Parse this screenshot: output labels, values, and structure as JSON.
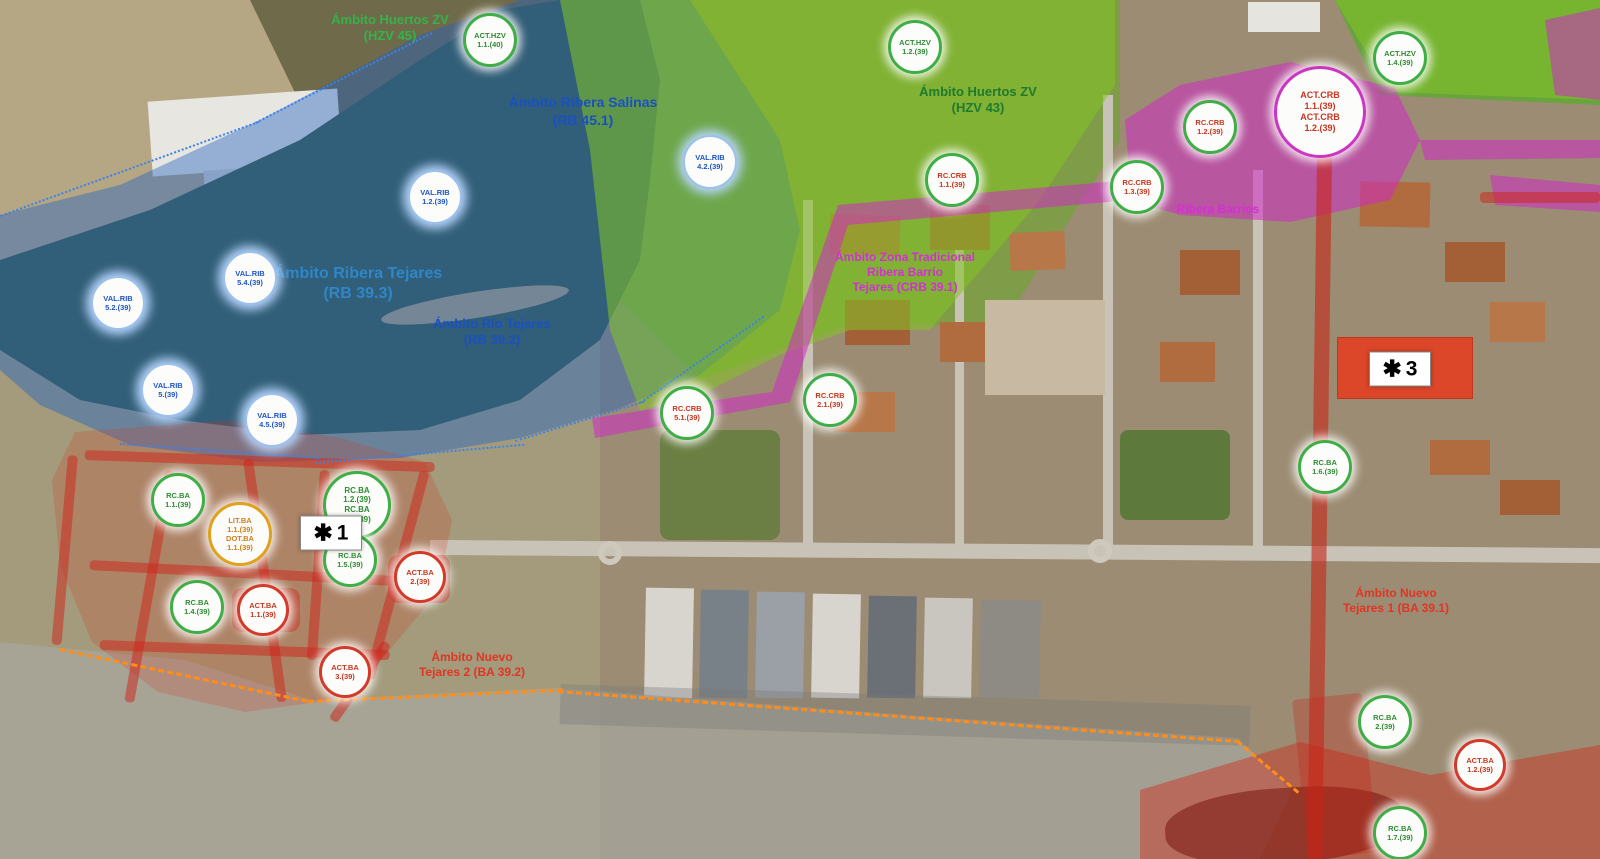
{
  "map": {
    "description": "Urban planning zoning overlay on aerial photo",
    "zone_colors": {
      "base": "#a39b7c",
      "tan_field": "#b5a684",
      "scrub": "#6f6a4a",
      "river": "#3e5c42",
      "sandbar": "#b3a176",
      "green_field_base": "#7f9c48",
      "grass_right": "#69a33e",
      "urban_base": "#9c8c73",
      "road_grey": "#c9c3b7",
      "blue_overlay": "rgba(32,98,196,0.42)",
      "green_overlay": "rgba(132,196,37,0.55)",
      "magenta_overlay": "rgba(207,42,196,0.55)",
      "red_overlay_blob": "rgba(214,48,34,0.22)",
      "red_road": "rgba(200,36,24,0.6)",
      "red_zone_br": "rgba(205,45,28,0.45)",
      "maroon_blob": "rgba(120,22,12,0.55)",
      "grey_overlay": "rgba(168,168,164,0.66)",
      "star3_zone": "rgba(232,58,28,0.85)"
    },
    "label_colors": {
      "green": "#35b24a",
      "darkgreen": "#1f7a2e",
      "blue": "#1b50c0",
      "lightblue": "#2f86c8",
      "magenta": "#d32fd3",
      "red": "#e03524"
    },
    "labels": [
      {
        "x": 390,
        "y": 12,
        "size": 13,
        "color": "green",
        "lines": [
          "Ámbito Huertos ZV",
          "(HZV 45)"
        ]
      },
      {
        "x": 583,
        "y": 94,
        "size": 14,
        "color": "blue",
        "lines": [
          "Ámbito Ribera Salinas",
          "(RB 45.1)"
        ]
      },
      {
        "x": 358,
        "y": 264,
        "size": 16,
        "color": "lightblue",
        "lines": [
          "Ámbito Ribera Tejares",
          "(RB 39.3)"
        ]
      },
      {
        "x": 492,
        "y": 316,
        "size": 13,
        "color": "blue",
        "lines": [
          "Ámbito Río Tejares",
          "(RB 39.2)"
        ]
      },
      {
        "x": 978,
        "y": 84,
        "size": 13,
        "color": "darkgreen",
        "lines": [
          "Ámbito Huertos ZV",
          "(HZV 43)"
        ]
      },
      {
        "x": 1218,
        "y": 202,
        "size": 12,
        "color": "magenta",
        "lines": [
          "Ribera Barrios"
        ]
      },
      {
        "x": 905,
        "y": 250,
        "size": 12,
        "color": "magenta",
        "lines": [
          "Ámbito Zona Tradicional",
          "Ribera Barrio",
          "Tejares (CRB 39.1)"
        ]
      },
      {
        "x": 472,
        "y": 650,
        "size": 12,
        "color": "red",
        "lines": [
          "Ámbito Nuevo",
          "Tejares 2 (BA 39.2)"
        ]
      },
      {
        "x": 1396,
        "y": 586,
        "size": 12,
        "color": "red",
        "lines": [
          "Ámbito Nuevo",
          "Tejares 1 (BA 39.1)"
        ]
      }
    ],
    "badges": [
      {
        "x": 490,
        "y": 40,
        "type": "act-hzv",
        "lines": [
          "ACT.HZV",
          "1.1.(40)"
        ]
      },
      {
        "x": 915,
        "y": 47,
        "type": "act-hzv",
        "lines": [
          "ACT.HZV",
          "1.2.(39)"
        ]
      },
      {
        "x": 1400,
        "y": 58,
        "type": "act-hzv",
        "lines": [
          "ACT.HZV",
          "1.4.(39)"
        ]
      },
      {
        "x": 710,
        "y": 162,
        "type": "val-rib",
        "lines": [
          "VAL.RIB",
          "4.2.(39)"
        ]
      },
      {
        "x": 435,
        "y": 197,
        "type": "val-rib",
        "lines": [
          "VAL.RIB",
          "1.2.(39)"
        ]
      },
      {
        "x": 250,
        "y": 278,
        "type": "val-rib",
        "lines": [
          "VAL.RIB",
          "5.4.(39)"
        ]
      },
      {
        "x": 118,
        "y": 303,
        "type": "val-rib",
        "lines": [
          "VAL.RIB",
          "5.2.(39)"
        ]
      },
      {
        "x": 168,
        "y": 390,
        "type": "val-rib",
        "lines": [
          "VAL.RIB",
          "5.(39)"
        ]
      },
      {
        "x": 272,
        "y": 420,
        "type": "val-rib",
        "lines": [
          "VAL.RIB",
          "4.5.(39)"
        ]
      },
      {
        "x": 1210,
        "y": 127,
        "type": "rc-crb",
        "lines": [
          "RC.CRB",
          "1.2.(39)"
        ]
      },
      {
        "x": 1320,
        "y": 112,
        "type": "act-crb",
        "lines": [
          "ACT.CRB",
          "1.1.(39)",
          "ACT.CRB",
          "1.2.(39)"
        ]
      },
      {
        "x": 952,
        "y": 180,
        "type": "rc-crb",
        "lines": [
          "RC.CRB",
          "1.1.(39)"
        ]
      },
      {
        "x": 1137,
        "y": 187,
        "type": "rc-crb",
        "lines": [
          "RC.CRB",
          "1.3.(39)"
        ]
      },
      {
        "x": 687,
        "y": 413,
        "type": "rc-crb",
        "lines": [
          "RC.CRB",
          "5.1.(39)"
        ]
      },
      {
        "x": 830,
        "y": 400,
        "type": "rc-crb",
        "lines": [
          "RC.CRB",
          "2.1.(39)"
        ]
      },
      {
        "x": 178,
        "y": 500,
        "type": "rc-ba",
        "lines": [
          "RC.BA",
          "1.1.(39)"
        ]
      },
      {
        "x": 357,
        "y": 505,
        "type": "rc-ba",
        "lines": [
          "RC.BA",
          "1.2.(39)",
          "RC.BA",
          "1.3.(39)"
        ]
      },
      {
        "x": 240,
        "y": 534,
        "type": "mixed-gold",
        "lines": [
          "LIT.BA",
          "1.1.(39)",
          "DOT.BA",
          "1.1.(39)"
        ]
      },
      {
        "x": 350,
        "y": 560,
        "type": "rc-ba",
        "lines": [
          "RC.BA",
          "1.5.(39)"
        ]
      },
      {
        "x": 420,
        "y": 577,
        "type": "act-ba",
        "lines": [
          "ACT.BA",
          "2.(39)"
        ]
      },
      {
        "x": 197,
        "y": 607,
        "type": "rc-ba",
        "lines": [
          "RC.BA",
          "1.4.(39)"
        ]
      },
      {
        "x": 263,
        "y": 610,
        "type": "act-ba",
        "lines": [
          "ACT.BA",
          "1.1.(39)"
        ]
      },
      {
        "x": 345,
        "y": 672,
        "type": "act-ba",
        "lines": [
          "ACT.BA",
          "3.(39)"
        ]
      },
      {
        "x": 1325,
        "y": 467,
        "type": "rc-ba",
        "lines": [
          "RC.BA",
          "1.6.(39)"
        ]
      },
      {
        "x": 1385,
        "y": 722,
        "type": "rc-ba",
        "lines": [
          "RC.BA",
          "2.(39)"
        ]
      },
      {
        "x": 1480,
        "y": 765,
        "type": "act-ba",
        "lines": [
          "ACT.BA",
          "1.2.(39)"
        ]
      },
      {
        "x": 1400,
        "y": 833,
        "type": "rc-ba",
        "lines": [
          "RC.BA",
          "1.7.(39)"
        ]
      }
    ],
    "markers": [
      {
        "x": 331,
        "y": 533,
        "asterisk": "✱",
        "number": "1"
      },
      {
        "x": 1400,
        "y": 369,
        "asterisk": "✱",
        "number": "3"
      }
    ]
  }
}
